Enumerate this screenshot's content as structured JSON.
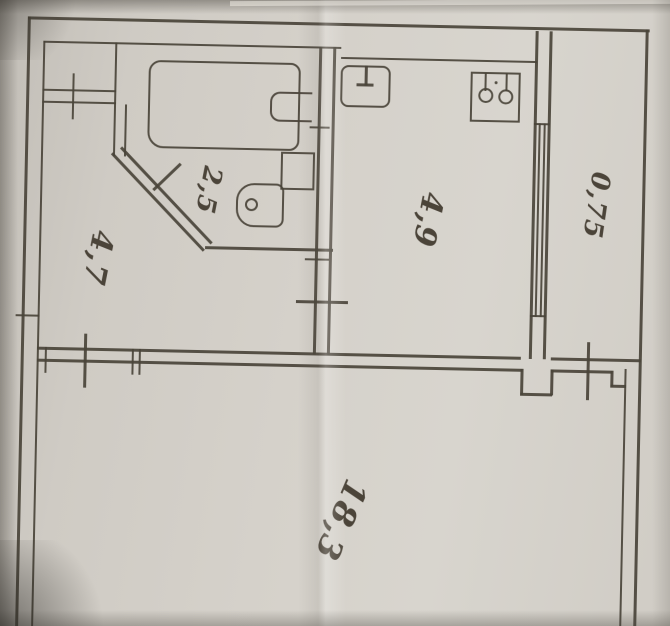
{
  "photo": {
    "paper_color": "#d3cfc8",
    "ink_color": "#4a443a"
  },
  "plan": {
    "room_area_labels": {
      "bathroom": "2,5",
      "hallway": "4,7",
      "kitchen": "4,9",
      "balcony": "0,75",
      "living_room": "18,3"
    },
    "fixture_icons": [
      "bathtub",
      "washbasin",
      "toilet",
      "kitchen-sink",
      "stove",
      "balcony-window",
      "door-opening-tick"
    ]
  }
}
